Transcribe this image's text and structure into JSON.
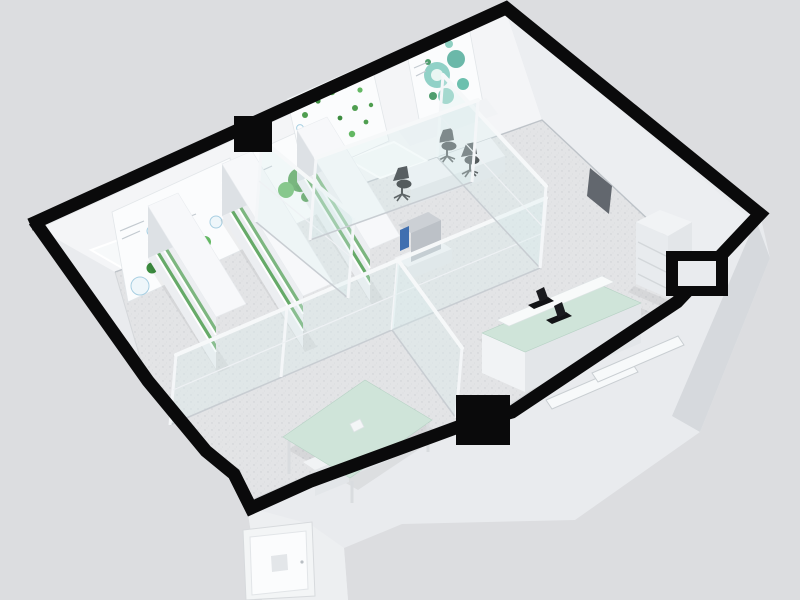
{
  "meta": {
    "title": "3D isometric cutaway rendering of a laboratory floor plan",
    "style": "photorealistic architectural render, no visible text",
    "canvas": {
      "width": 800,
      "height": 600
    }
  },
  "palette": {
    "bg": "#dcdde0",
    "wall-cut": "#0a0a0b",
    "ext-wall": "#e9ebee",
    "ext-wall-dark": "#d6d9dd",
    "ext-door-bay": "#edeff1",
    "floor": "#e3e4e6",
    "floor-speckle": "#cbced2",
    "wall-face": "#f4f5f7",
    "wall-face-shade": "#eceef1",
    "window": "#f7f9fa",
    "frame": "#ffffff",
    "glass": "#dceef0",
    "glass-rail": "#f6f8f9",
    "furniture": "#f1f3f5",
    "furniture-shade": "#e3e6e9",
    "mint": "#cfe4d9",
    "plant": "#4f9e50",
    "plant-dark": "#3c8c3f",
    "teal": "#7ec9bd",
    "equip-dark": "#17181b",
    "panel-dark": "#62676e",
    "screen-blue": "#3f6fb0",
    "steel": "#c3c8cd"
  },
  "scene": {
    "building": {
      "type": "single-storey laboratory, walls cut in plan view (black cut tops)",
      "rooms": [
        "plant growth room",
        "glass-walled office",
        "instrument room",
        "open lab",
        "entrance bay"
      ]
    },
    "objects": {
      "posters": {
        "count": 4,
        "description": "botanical / cell-culture wall posters with green and teal graphics"
      },
      "back_wall_windows": {
        "count": 5
      },
      "grow_racks": {
        "count": 3,
        "description": "white shelving racks with rows of green plants"
      },
      "office_desks": {
        "count": 1,
        "overhead_cabinet": true
      },
      "office_chairs": {
        "count": 3,
        "color": "black"
      },
      "analyzer_machine": {
        "count": 1,
        "screen_color": "blue"
      },
      "island_bench": {
        "count": 1,
        "top_color": "mint green",
        "microscopes": 2
      },
      "drawer_cabinet": {
        "count": 1,
        "drawers": 3
      },
      "meeting_table": {
        "count": 1,
        "top_color": "mint green",
        "under_cabinets": 2
      },
      "glass_partitions": {
        "count": 6,
        "frame_color": "white"
      },
      "exterior_door": {
        "count": 1,
        "vent": true
      },
      "front_window_slots": {
        "count": 2
      },
      "wall_columns": {
        "count": 2,
        "color": "black"
      },
      "service_niche": {
        "count": 1
      }
    }
  }
}
